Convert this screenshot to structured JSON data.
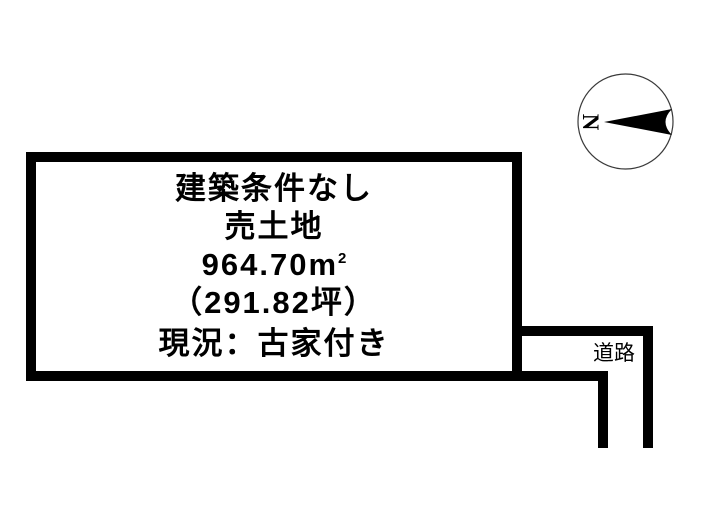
{
  "diagram": {
    "parcel": {
      "title": "建築条件なし",
      "sale_type": "売土地",
      "area_value": "964.70",
      "area_unit": "m",
      "area_unit_exponent": "2",
      "area_tsubo": "（291.82坪）",
      "condition": "現況：古家付き"
    },
    "road": {
      "label": "道路"
    },
    "compass": {
      "north_label": "N"
    }
  },
  "colors": {
    "background": "#ffffff",
    "line": "#000000",
    "text": "#000000",
    "compass_circle_stroke": "#3a3a3a"
  }
}
